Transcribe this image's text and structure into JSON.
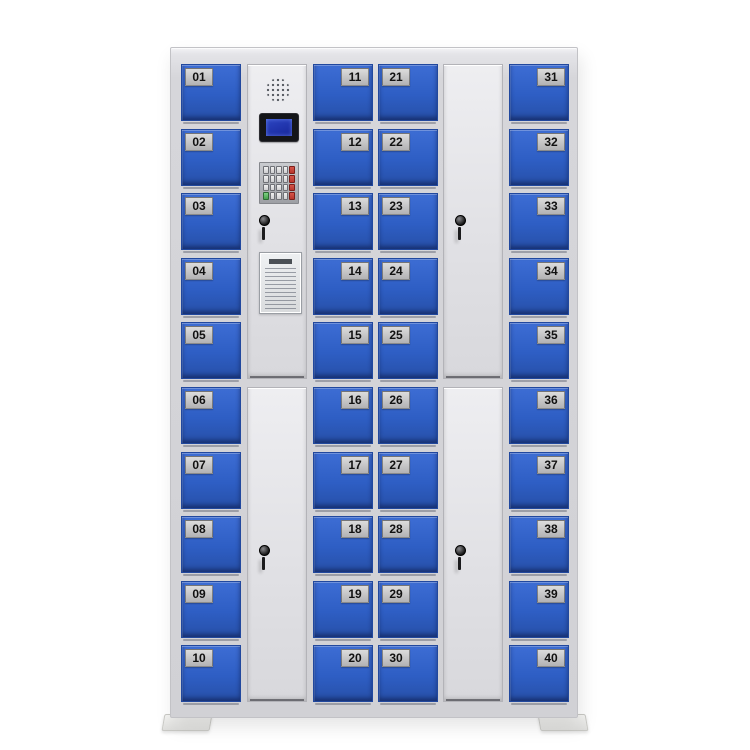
{
  "colors": {
    "background": "#ffffff",
    "frame": "#d6d6da",
    "white_door": "#e0e0e4",
    "door_blue": "#2e5ec4",
    "door_blue_dark": "#21489e",
    "plate_silver": "#dcdcdc",
    "plate_text": "#111111",
    "lcd_screen_blue": "#2c45c2",
    "keypad_red": "#b9352c",
    "keypad_green": "#46a14d"
  },
  "locker_columns": [
    {
      "name": "locker-column-1",
      "grid_col": 0,
      "plate_side": "left",
      "numbers": [
        "01",
        "02",
        "03",
        "04",
        "05",
        "06",
        "07",
        "08",
        "09",
        "10"
      ]
    },
    {
      "name": "locker-column-3",
      "grid_col": 2,
      "plate_side": "right",
      "numbers": [
        "11",
        "12",
        "13",
        "14",
        "15",
        "16",
        "17",
        "18",
        "19",
        "20"
      ]
    },
    {
      "name": "locker-column-4",
      "grid_col": 3,
      "plate_side": "left",
      "numbers": [
        "21",
        "22",
        "23",
        "24",
        "25",
        "26",
        "27",
        "28",
        "29",
        "30"
      ]
    },
    {
      "name": "locker-column-6",
      "grid_col": 5,
      "plate_side": "right",
      "numbers": [
        "31",
        "32",
        "33",
        "34",
        "35",
        "36",
        "37",
        "38",
        "39",
        "40"
      ]
    }
  ],
  "control_panel": {
    "devices": [
      "speaker-grille",
      "lcd-display",
      "keypad",
      "key-lock",
      "instructions-placard"
    ]
  },
  "keypad": {
    "rows": [
      [
        "key",
        "key",
        "key",
        "key",
        "fn-red"
      ],
      [
        "key",
        "key",
        "key",
        "key",
        "fn-red"
      ],
      [
        "key",
        "key",
        "key",
        "key",
        "fn-red"
      ],
      [
        "fn-green",
        "key",
        "key",
        "key",
        "fn-red"
      ]
    ]
  },
  "large_doors": [
    {
      "name": "control-column-lower-door",
      "grid_col": 1,
      "row": "bottom",
      "has_lock": true
    },
    {
      "name": "blank-column-upper-door",
      "grid_col": 4,
      "row": "top",
      "has_lock": true
    },
    {
      "name": "blank-column-lower-door",
      "grid_col": 4,
      "row": "bottom",
      "has_lock": true
    }
  ]
}
